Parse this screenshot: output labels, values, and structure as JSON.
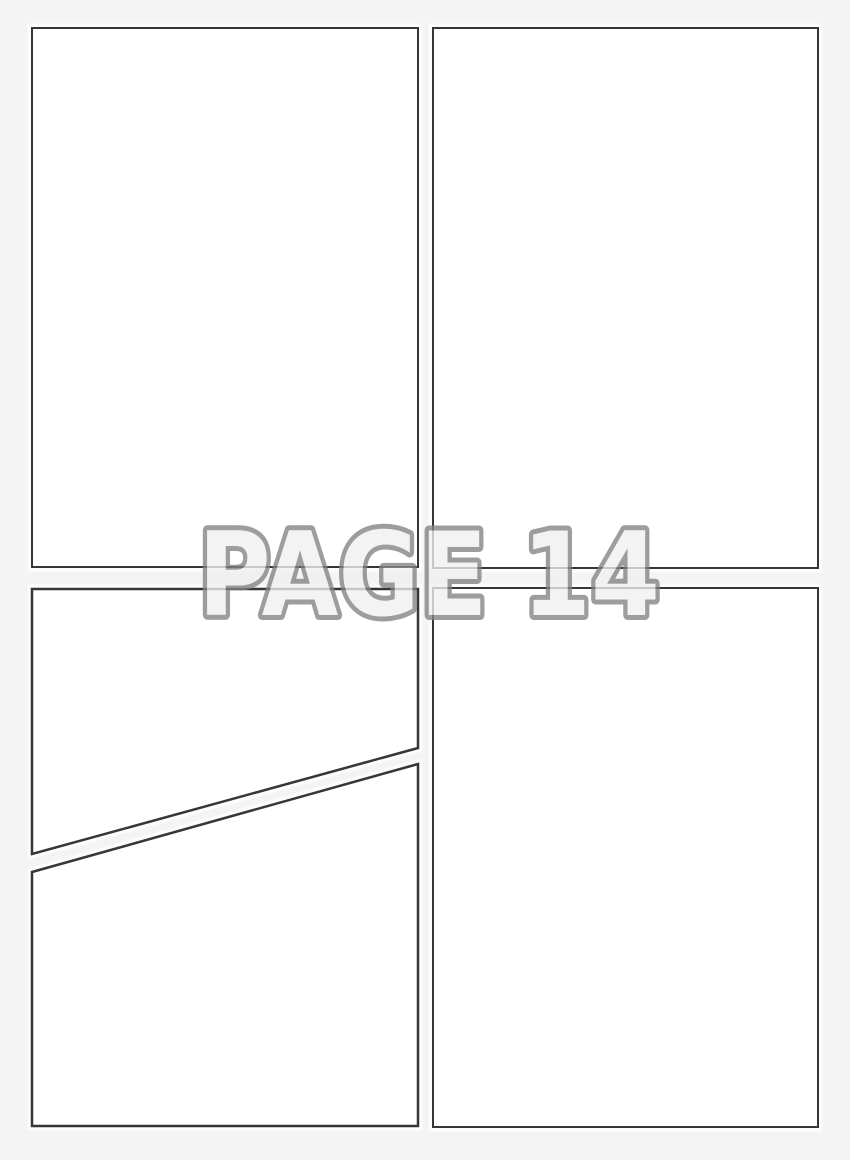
{
  "page": {
    "watermark": "PAGE 14"
  },
  "panels": [
    {
      "id": "panel-top-left",
      "shape": "rectangle"
    },
    {
      "id": "panel-top-right",
      "shape": "rectangle"
    },
    {
      "id": "panel-middle-left",
      "shape": "trapezoid"
    },
    {
      "id": "panel-bottom-left",
      "shape": "trapezoid"
    },
    {
      "id": "panel-bottom-right",
      "shape": "rectangle"
    }
  ],
  "colors": {
    "page-bg": "#f4f4f4",
    "panel-fill": "#ffffff",
    "panel-border": "#363636",
    "wm-fill": "#f0f0f0",
    "wm-outline": "#828282"
  }
}
